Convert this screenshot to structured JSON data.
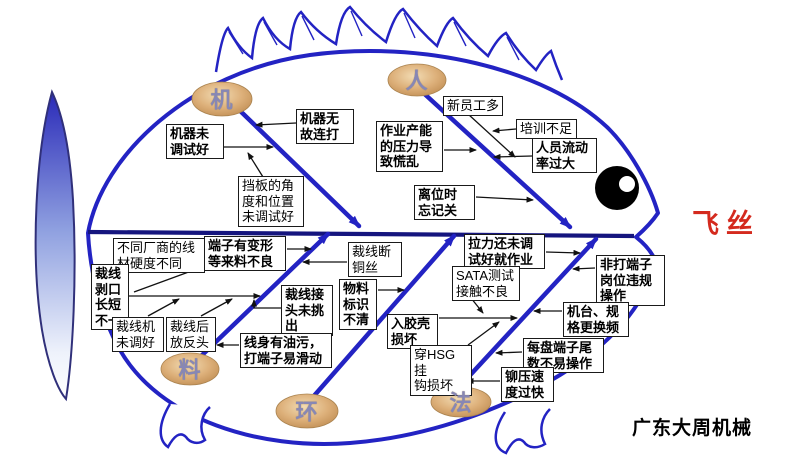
{
  "effect": {
    "label": "飞丝"
  },
  "watermark": "广东大周机械",
  "bones": {
    "machine": {
      "label": "机"
    },
    "man": {
      "label": "人"
    },
    "material": {
      "label": "料"
    },
    "environment": {
      "label": "环"
    },
    "method": {
      "label": "法"
    }
  },
  "causes": {
    "machine_not_tuned": "机器未\n调试好",
    "machine_random_strike": "机器无\n故连打",
    "baffle_angle": "挡板的角\n度和位置\n未调试好",
    "new_employees": "新员工多",
    "insufficient_training": "培训不足",
    "high_turnover": "人员流动\n率过大",
    "capacity_pressure": "作业产能\n的压力导\n致慌乱",
    "forget_off_when_leaving": "离位时\n忘记关",
    "wire_hardness_differs": "不同厂商的线\n材硬度不同",
    "terminal_deformed": "端子有变形\n等来料不良",
    "strip_length_uneven": "裁线\n剥口\n长短\n不一",
    "cutter_not_tuned": "裁线机\n未调好",
    "reversed_after_cut": "裁线后\n放反头",
    "joint_not_picked": "裁线接\n头未挑\n出",
    "oily_wire_slip": "线身有油污，\n打端子易滑动",
    "copper_wire_break": "裁线断\n铜丝",
    "label_unclear": "物料\n标识\n不清",
    "shell_insert_damage": "入胶壳\n损坏",
    "hsg_hook_damage": "穿HSG挂\n钩损坏",
    "tension_not_tuned": "拉力还未调\n试好就作业",
    "sata_contact_bad": "SATA测试\n接触不良",
    "illegal_operation": "非打端子\n岗位违规\n操作",
    "frequent_changeover": "机台、规\n格更换频",
    "reel_tail_hard": "每盘端子尾\n数不易操作",
    "crimp_speed_fast": "铆压速\n度过快"
  },
  "colors": {
    "bone_blue": "#2323c3",
    "spine_navy": "#15157e",
    "effect_red": "#d42a1e",
    "oval_tan": "#d9a86c"
  }
}
